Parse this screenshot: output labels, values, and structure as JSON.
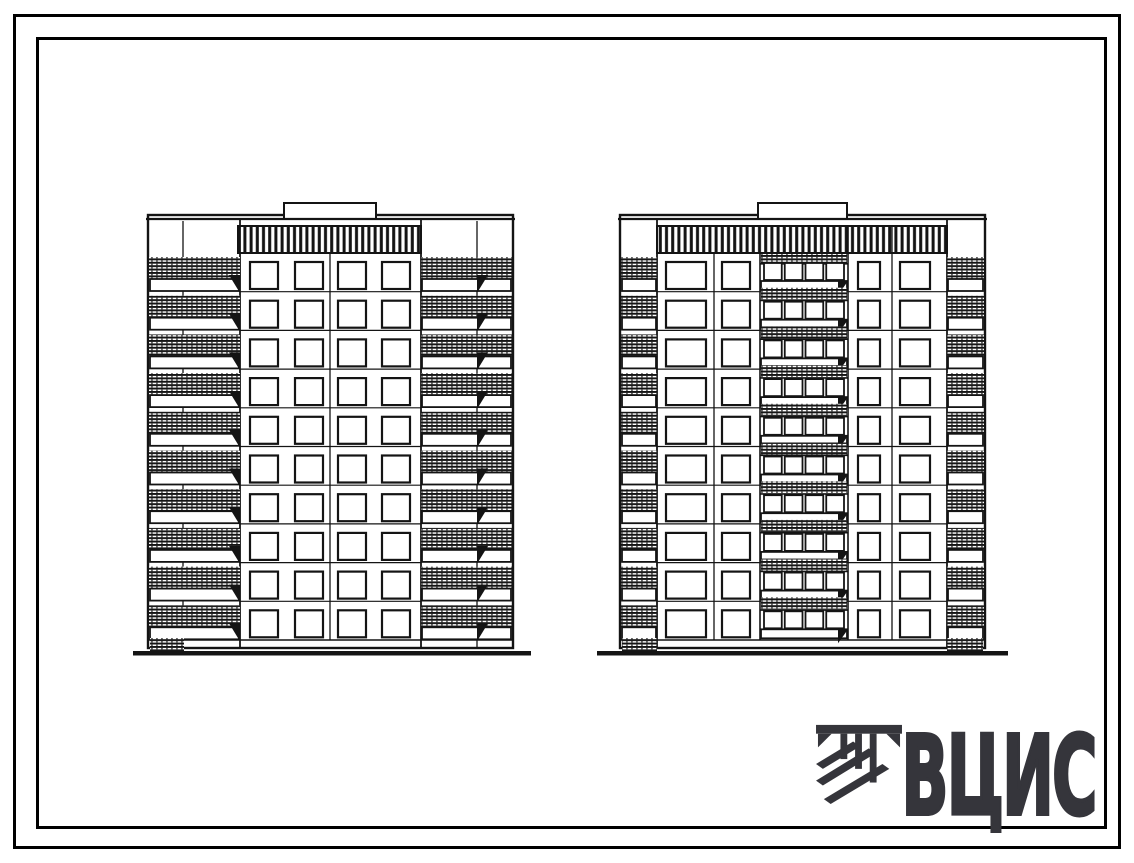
{
  "logo": {
    "text": "ВЦИС",
    "color": "#35353b"
  },
  "elevations": {
    "ink": "#141414",
    "floors": 10,
    "first_row_y": 262,
    "floor_pitch": 38.7,
    "ground_thickness": 4.5,
    "buildings": [
      {
        "label": "left-block-section-elevation",
        "x1": 148,
        "x2": 513,
        "top": 215,
        "parapet_y": 219,
        "bottom": 648,
        "penthouse": {
          "x1": 284,
          "x2": 376,
          "y": 203
        },
        "frieze": {
          "x1": 238,
          "x2": 421,
          "y1": 226,
          "y2": 253
        },
        "vlines": [
          {
            "x": 183,
            "y1": 221,
            "y2": 648,
            "w": 1.3
          },
          {
            "x": 240,
            "y1": 219,
            "y2": 648,
            "w": 1.8
          },
          {
            "x": 330,
            "y1": 253,
            "y2": 640,
            "w": 1.3
          },
          {
            "x": 421,
            "y1": 219,
            "y2": 648,
            "w": 1.8
          },
          {
            "x": 477,
            "y1": 221,
            "y2": 648,
            "w": 1.3
          }
        ],
        "floor_line": {
          "x1": 240,
          "x2": 421
        },
        "window_cols": [
          {
            "x": 250,
            "w": 28
          },
          {
            "x": 295,
            "w": 28
          },
          {
            "x": 338,
            "w": 28
          },
          {
            "x": 382,
            "w": 28
          }
        ],
        "window_h": 27,
        "strips": [
          {
            "x1": 149,
            "x2": 240,
            "bracket_x": 229,
            "bracket_dir": "r"
          },
          {
            "x1": 421,
            "x2": 512,
            "bracket_x": 477,
            "bracket_dir": "l"
          }
        ],
        "loggia": null,
        "base_patches": [
          {
            "x1": 150,
            "x2": 184
          }
        ],
        "ground": {
          "x1": 133,
          "x2": 531
        }
      },
      {
        "label": "right-block-section-elevation",
        "x1": 620,
        "x2": 985,
        "top": 215,
        "parapet_y": 219,
        "bottom": 648,
        "penthouse": {
          "x1": 758,
          "x2": 847,
          "y": 203
        },
        "frieze": {
          "x1": 657,
          "x2": 947,
          "y1": 226,
          "y2": 253
        },
        "vlines": [
          {
            "x": 657,
            "y1": 219,
            "y2": 648,
            "w": 1.8
          },
          {
            "x": 714,
            "y1": 253,
            "y2": 640,
            "w": 1.3
          },
          {
            "x": 760,
            "y1": 253,
            "y2": 640,
            "w": 1.6
          },
          {
            "x": 848,
            "y1": 226,
            "y2": 640,
            "w": 1.6
          },
          {
            "x": 892,
            "y1": 226,
            "y2": 640,
            "w": 1.3
          },
          {
            "x": 947,
            "y1": 219,
            "y2": 648,
            "w": 1.8
          }
        ],
        "floor_line": {
          "x1": 657,
          "x2": 947
        },
        "window_cols": [
          {
            "x": 666,
            "w": 40
          },
          {
            "x": 722,
            "w": 28
          },
          {
            "x": 858,
            "w": 22
          },
          {
            "x": 900,
            "w": 30
          }
        ],
        "window_h": 27,
        "strips": [
          {
            "x1": 621,
            "x2": 657,
            "bracket_x": null,
            "bracket_dir": null
          },
          {
            "x1": 947,
            "x2": 984,
            "bracket_x": null,
            "bracket_dir": null
          }
        ],
        "loggia": {
          "x1": 760,
          "x2": 848,
          "panes": 4,
          "bracket_x": 838
        },
        "base_patches": [
          {
            "x1": 622,
            "x2": 657
          },
          {
            "x1": 947,
            "x2": 983
          }
        ],
        "ground": {
          "x1": 597,
          "x2": 1008
        }
      }
    ]
  }
}
